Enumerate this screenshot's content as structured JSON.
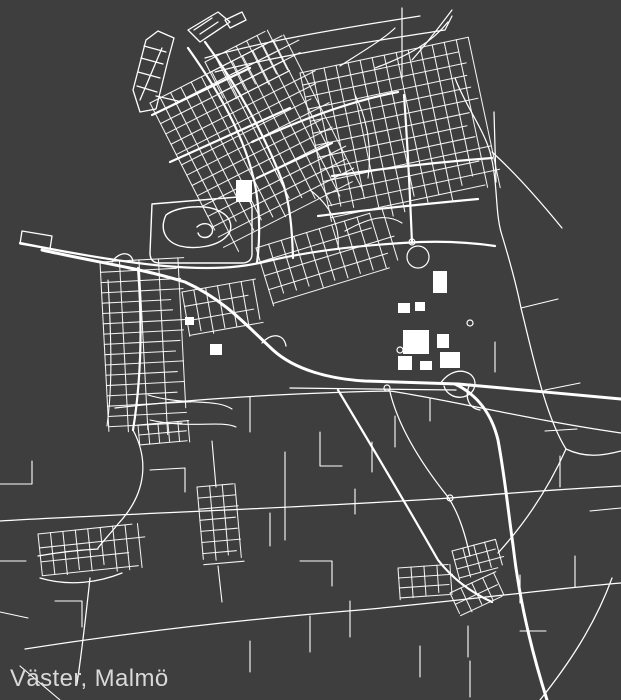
{
  "title": {
    "label": "Väster, Malmö"
  },
  "map": {
    "region_name": "Väster",
    "city_name": "Malmö",
    "background": "#3e3e3e",
    "road_color": "#ffffff",
    "label_color": "#d9d9d9",
    "viewbox": "0 0 621 700",
    "grids": [
      {
        "x": 150,
        "y": 103,
        "a": -27,
        "w": 150,
        "h": 162,
        "nx": 13,
        "ny": 14
      },
      {
        "x": 300,
        "y": 73,
        "a": -12,
        "w": 172,
        "h": 148,
        "nx": 14,
        "ny": 12
      },
      {
        "x": 256,
        "y": 248,
        "a": -17,
        "w": 132,
        "h": 58,
        "nx": 10,
        "ny": 4
      },
      {
        "x": 100,
        "y": 262,
        "a": -3,
        "w": 78,
        "h": 165,
        "nx": 4,
        "ny": 16
      },
      {
        "x": 205,
        "y": 62,
        "a": -27,
        "w": 70,
        "h": 46,
        "nx": 6,
        "ny": 4
      },
      {
        "x": 452,
        "y": 551,
        "a": -15,
        "w": 45,
        "h": 28,
        "nx": 4,
        "ny": 3
      },
      {
        "x": 398,
        "y": 568,
        "a": -4,
        "w": 52,
        "h": 30,
        "nx": 4,
        "ny": 3
      },
      {
        "x": 450,
        "y": 593,
        "a": -25,
        "w": 48,
        "h": 25,
        "nx": 4,
        "ny": 2
      },
      {
        "x": 38,
        "y": 534,
        "a": -6,
        "w": 100,
        "h": 42,
        "nx": 8,
        "ny": 3
      },
      {
        "x": 197,
        "y": 487,
        "a": -5,
        "w": 38,
        "h": 78,
        "nx": 3,
        "ny": 7
      },
      {
        "x": 138,
        "y": 425,
        "a": -5,
        "w": 50,
        "h": 20,
        "nx": 5,
        "ny": 2
      },
      {
        "x": 182,
        "y": 292,
        "a": -10,
        "w": 72,
        "h": 44,
        "nx": 6,
        "ny": 3
      }
    ],
    "layers": [
      {
        "name": "piers",
        "width": 1.3,
        "paths": [
          "M133,90 L146,40 L158,31 L174,38 L168,60 L156,109 L140,112 Z",
          "M140,100 L162,48",
          "M138,72 L160,78",
          "M141,58 L163,64",
          "M144,46 L166,52",
          "M137,86 L157,92",
          "M156,96 L178,101",
          "M188,30 L218,12 L230,22 L200,42 Z",
          "M194,30 L212,18",
          "M200,34 L218,22",
          "M206,38 L224,26",
          "M225,20 L242,12 L246,20 L230,28 Z",
          "M22,231 L52,236 L50,249 L20,244 Z"
        ]
      },
      {
        "name": "quarry",
        "width": 1.4,
        "paths": [
          "M152,204 L238,197 C247,197 252,202 252,208 L252,254 C252,260 248,263 242,263 L159,263 C153,263 150,259 150,253 Z",
          "M166,215 C178,206 206,204 219,211 C232,217 234,229 226,237 C217,246 196,250 180,246 C166,242 159,230 166,215 Z",
          "M197,227 C205,220 215,225 212,233 C209,239 200,239 198,233"
        ]
      },
      {
        "name": "beach-paths",
        "width": 1.2,
        "paths": [
          "M205,58 C260,42 330,30 420,16",
          "M215,72 C280,55 355,44 445,30 L452,16",
          "M340,66 C365,50 385,38 395,28",
          "M375,68 C410,55 432,42 448,22",
          "M402,8 L402,78",
          "M412,60 C428,42 440,26 452,10"
        ]
      },
      {
        "name": "rural-roads",
        "width": 1.25,
        "paths": [
          "M115,408 C200,398 300,393 390,391 C440,398 530,420 621,433",
          "M0,521 C120,514 300,508 450,498 C510,493 565,489 621,486",
          "M25,649 C140,631 260,618 360,610 C460,601 540,590 621,583",
          "M390,392 C398,425 420,462 448,497 C460,515 466,538 470,556",
          "M455,78 C465,105 483,128 490,152 C498,182 495,210 501,232",
          "M501,232 C512,268 517,288 521,308 C533,356 545,415 566,449",
          "M566,449 C585,458 602,456 621,451",
          "M566,449 C550,485 528,520 498,553",
          "M492,152 C512,170 535,195 562,228",
          "M494,112 L496,182",
          "M612,578 C595,625 568,665 540,700",
          "M90,578 C86,615 82,650 77,684",
          "M38,556 C60,552 80,550 98,549",
          "M40,578 C70,587 100,582 122,573",
          "M133,430 C148,458 148,492 118,524 C110,534 104,540 98,548"
        ]
      },
      {
        "name": "minor-roads",
        "width": 1.1,
        "paths": [
          "M150,470 L185,468 L185,492",
          "M250,397 L250,432",
          "M285,452 L285,540",
          "M320,432 L320,466 L342,466",
          "M355,489 L355,514",
          "M372,442 L372,472",
          "M395,416 L395,447",
          "M430,399 L430,421",
          "M270,513 L270,546",
          "M300,561 L332,561 L332,586",
          "M545,431 L577,429",
          "M560,456 L560,487",
          "M590,511 L621,508",
          "M575,556 L575,587",
          "M0,484 L32,484 L32,461",
          "M0,561 L26,561",
          "M55,601 L82,601 L82,627",
          "M310,616 L310,652",
          "M350,601 L350,637",
          "M420,646 L420,677",
          "M470,661 L470,697",
          "M520,631 L546,631",
          "M250,641 L250,672",
          "M20,666 L60,700",
          "M212,441 L216,487",
          "M218,566 L222,602",
          "M520,575 L520,603",
          "M468,626 L468,657",
          "M148,395 C185,406 215,398 232,409",
          "M150,420 C190,429 222,420 236,427",
          "M108,280 C112,350 112,390 107,426",
          "M345,231 C372,216 388,214 402,223",
          "M521,308 L558,299",
          "M545,390 L580,383",
          "M0,612 L28,618",
          "M495,342 L495,372",
          "M310,190 C330,205 340,225 338,248",
          "M355,95 C368,120 372,150 368,178"
        ]
      },
      {
        "name": "major-streets",
        "width": 2.2,
        "paths": [
          "M20,243 C70,253 120,262 165,266 C210,270 240,268 268,261 C310,251 360,245 420,242 C450,241 475,243 495,246",
          "M188,48 C225,100 248,145 256,190 C260,215 260,240 257,263",
          "M205,42 C238,86 266,138 283,183 C290,205 292,228 293,258",
          "M152,115 L250,68",
          "M170,162 L290,108",
          "M257,178 L332,143",
          "M404,95 C408,150 410,195 412,243",
          "M332,176 C385,168 440,162 492,158",
          "M318,216 C372,209 425,204 478,199",
          "M252,142 C300,120 350,101 398,92",
          "M138,268 C142,320 142,375 133,430",
          "M338,390 C365,435 398,490 438,560 C452,578 470,592 492,602"
        ]
      },
      {
        "name": "motorway",
        "width": 3,
        "paths": [
          "M42,250 C95,262 140,268 185,282 C225,300 248,327 273,350 C295,370 330,379 365,381 L458,384",
          "M458,384 C510,389 570,394 621,399",
          "M455,384 C478,395 492,415 498,440 C505,478 508,510 513,545 C518,590 528,640 547,700"
        ]
      },
      {
        "name": "ramps",
        "width": 1.3,
        "paths": [
          "M290,388 L456,390",
          "M440,384 C448,372 460,368 470,374 C478,380 476,392 466,396 C456,400 446,394 444,386",
          "M470,384 C464,396 468,408 480,410",
          "M262,343 C272,332 284,334 286,346",
          "M112,262 C120,250 132,252 133,262"
        ]
      }
    ],
    "blocks": [
      [
        236,
        180,
        16,
        22
      ],
      [
        433,
        271,
        14,
        22
      ],
      [
        403,
        330,
        26,
        24
      ],
      [
        437,
        334,
        12,
        14
      ],
      [
        440,
        352,
        20,
        16
      ],
      [
        398,
        356,
        14,
        14
      ],
      [
        420,
        361,
        12,
        9
      ],
      [
        210,
        344,
        12,
        11
      ],
      [
        185,
        317,
        9,
        8
      ],
      [
        415,
        302,
        10,
        9
      ],
      [
        398,
        303,
        12,
        10
      ]
    ],
    "circles": [
      [
        400,
        350,
        3
      ],
      [
        470,
        323,
        3
      ],
      [
        387,
        388,
        3
      ],
      [
        450,
        498,
        3
      ],
      [
        418,
        257,
        11
      ],
      [
        412,
        242,
        3
      ]
    ]
  }
}
